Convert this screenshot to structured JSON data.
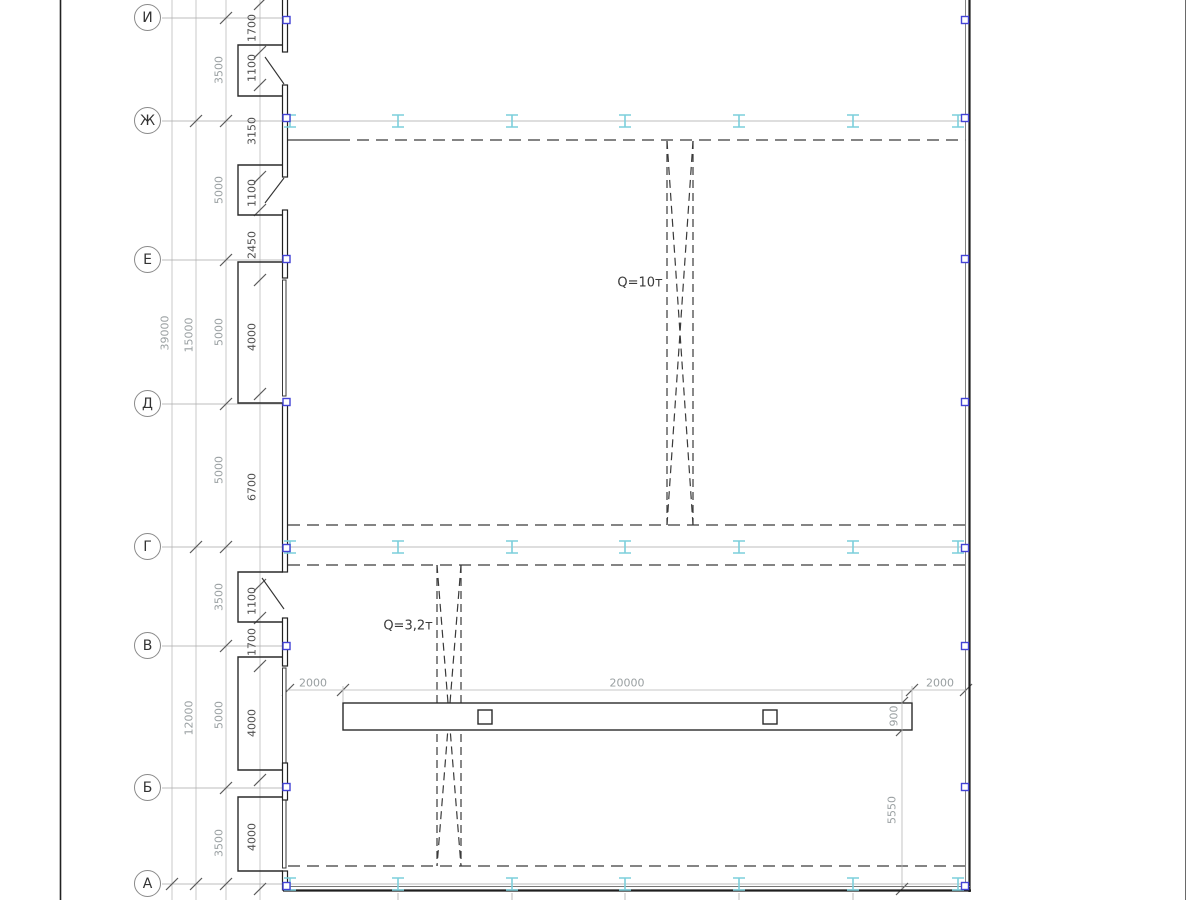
{
  "drawing": {
    "axes": {
      "bubbles": [
        "И",
        "Ж",
        "Е",
        "Д",
        "Г",
        "В",
        "Б",
        "А"
      ]
    },
    "cranes": {
      "bridge_crane_label": "Q=10т",
      "monorail_crane_label": "Q=3,2т"
    },
    "dims": {
      "overall": "39000",
      "section_upper": "15000",
      "section_lower": "12000",
      "axis_spacing": [
        "3500",
        "5000",
        "5000",
        "5000",
        "3500",
        "5000",
        "3500"
      ],
      "wall_segments": [
        "1700",
        "1100",
        "3150",
        "1100",
        "2450",
        "4000",
        "6700",
        "1100",
        "1700",
        "4000",
        "4000"
      ],
      "beam_offsets": [
        "2000",
        "20000",
        "2000"
      ],
      "beam_height": "900",
      "beam_to_wall": "5550"
    },
    "colors": {
      "column_marker_blue": "#4343d6",
      "rail_symbol_cyan": "#7ccfdb",
      "wall_line_dark": "#2a2a2a",
      "dim_text_gray": "#9aa0a2",
      "dim_text_dark": "#4f4f4f"
    },
    "icons": {
      "column_marker": "square-outline-icon",
      "rail_support": "i-beam-icon"
    }
  }
}
